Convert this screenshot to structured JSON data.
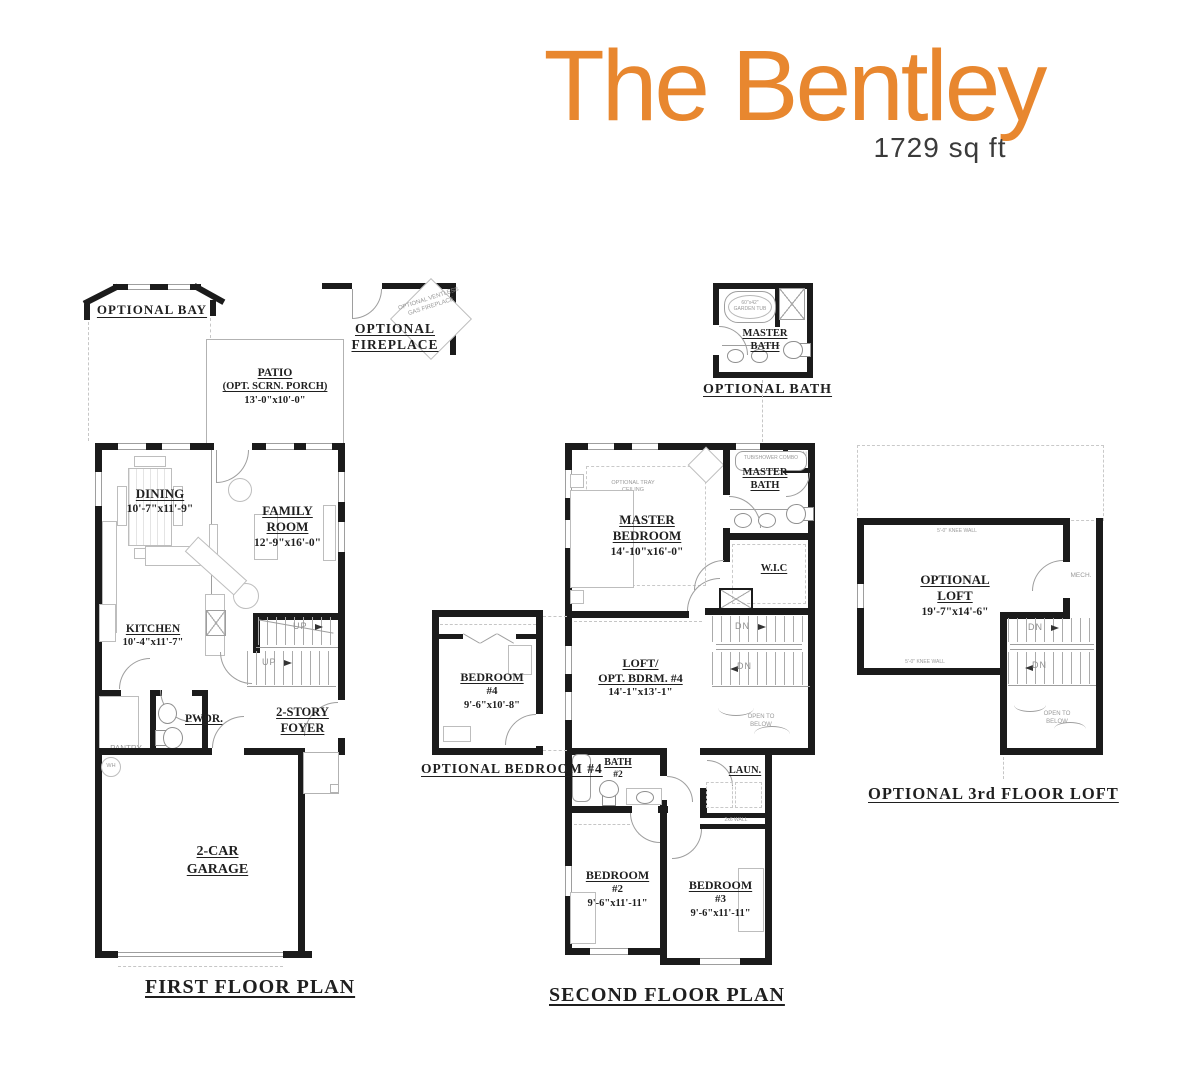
{
  "header": {
    "title": "The Bentley",
    "sqft": "1729 sq ft",
    "accent_color": "#E8872F"
  },
  "first_floor": {
    "caption": "FIRST FLOOR PLAN",
    "optional_bay": "OPTIONAL BAY",
    "optional_fireplace_l1": "OPTIONAL",
    "optional_fireplace_l2": "FIREPLACE",
    "fireplace_note": "OPTIONAL VENTLESS GAS FIREPLACE",
    "patio_l1": "PATIO",
    "patio_l2": "(OPT. SCRN. PORCH)",
    "patio_dim": "13'-0\"x10'-0\"",
    "dining": "DINING",
    "dining_dim": "10'-7\"x11'-9\"",
    "family_l1": "FAMILY",
    "family_l2": "ROOM",
    "family_dim": "12'-9\"x16'-0\"",
    "kitchen": "KITCHEN",
    "kitchen_dim": "10'-4\"x11'-7\"",
    "pantry": "PANTRY",
    "powder": "PWDR.",
    "foyer_l1": "2-STORY",
    "foyer_l2": "FOYER",
    "garage_l1": "2-CAR",
    "garage_l2": "GARAGE",
    "up": "UP",
    "wh": "WH"
  },
  "optional_bath": {
    "caption": "OPTIONAL BATH",
    "room_l1": "MASTER",
    "room_l2": "BATH",
    "garden_tub": "60\"x42\" GARDEN TUB"
  },
  "second_floor": {
    "caption": "SECOND FLOOR PLAN",
    "master_l1": "MASTER",
    "master_l2": "BEDROOM",
    "master_dim": "14'-10\"x16'-0\"",
    "tray_note": "OPTIONAL TRAY CEILING",
    "master_bath_l1": "MASTER",
    "master_bath_l2": "BATH",
    "tub_note": "TUB/SHOWER COMBO",
    "linen": "LINEN",
    "wic": "W.I.C",
    "loft_l1": "LOFT/",
    "loft_l2": "OPT. BDRM. #4",
    "loft_dim": "14'-1\"x13'-1\"",
    "dn": "DN",
    "open_below": "OPEN TO BELOW",
    "laundry": "LAUN.",
    "wall_note": "2x6 WALL",
    "bath2_l1": "BATH",
    "bath2_l2": "#2",
    "bed2_l1": "BEDROOM",
    "bed2_l2": "#2",
    "bed2_dim": "9'-6\"x11'-11\"",
    "bed3_l1": "BEDROOM",
    "bed3_l2": "#3",
    "bed3_dim": "9'-6\"x11'-11\""
  },
  "optional_bedroom4": {
    "caption": "OPTIONAL BEDROOM #4",
    "room_l1": "BEDROOM",
    "room_l2": "#4",
    "room_dim": "9'-6\"x10'-8\""
  },
  "third_floor_loft": {
    "caption": "OPTIONAL 3rd FLOOR LOFT",
    "room_l1": "OPTIONAL",
    "room_l2": "LOFT",
    "room_dim": "19'-7\"x14'-6\"",
    "knee_wall": "5'-0\" KNEE WALL",
    "mech": "MECH.",
    "dn": "DN",
    "open_below": "OPEN TO BELOW"
  }
}
